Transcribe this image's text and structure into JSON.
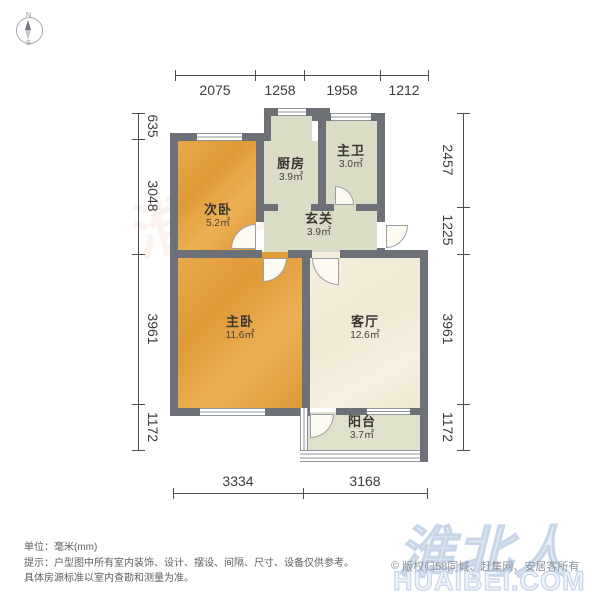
{
  "compass": {
    "north": "N",
    "south": "S"
  },
  "dimensions": {
    "top": [
      "2075",
      "1258",
      "1958",
      "1212"
    ],
    "left": [
      "635",
      "3048",
      "3961",
      "1172"
    ],
    "right": [
      "2457",
      "1225",
      "3961",
      "1172"
    ],
    "bottom": [
      "3334",
      "3168"
    ]
  },
  "rooms": [
    {
      "name": "次卧",
      "area": "5.2㎡"
    },
    {
      "name": "厨房",
      "area": "3.9㎡"
    },
    {
      "name": "主卫",
      "area": "3.0㎡"
    },
    {
      "name": "玄关",
      "area": "3.9㎡"
    },
    {
      "name": "主卧",
      "area": "11.6㎡"
    },
    {
      "name": "客厅",
      "area": "12.6㎡"
    },
    {
      "name": "阳台",
      "area": "3.7㎡"
    }
  ],
  "footer": {
    "unit": "单位：毫米(mm)",
    "tip1": "提示：户型图中所有室内装饰、设计、摆设、间隔、尺寸、设备仅供参考。",
    "tip2": "具体房源标准以室内查勘和测量为准。"
  },
  "watermark": {
    "brand": "淮北人",
    "domain": "HUAIBEI.COM",
    "copyright_symbol": "©",
    "copyright": "版权归58同城、赶集网、安居客所有"
  },
  "colors": {
    "wall": "#6d7076",
    "bedroom_fill": "#e2a246",
    "utility_fill": "#dbdcc5",
    "living_fill": "#f3edda",
    "balcony_fill": "#e0e1cb",
    "dimension_text": "#3c3c3c",
    "watermark_blue": "#c8d6e9",
    "footer_text": "#5f5f5f"
  }
}
